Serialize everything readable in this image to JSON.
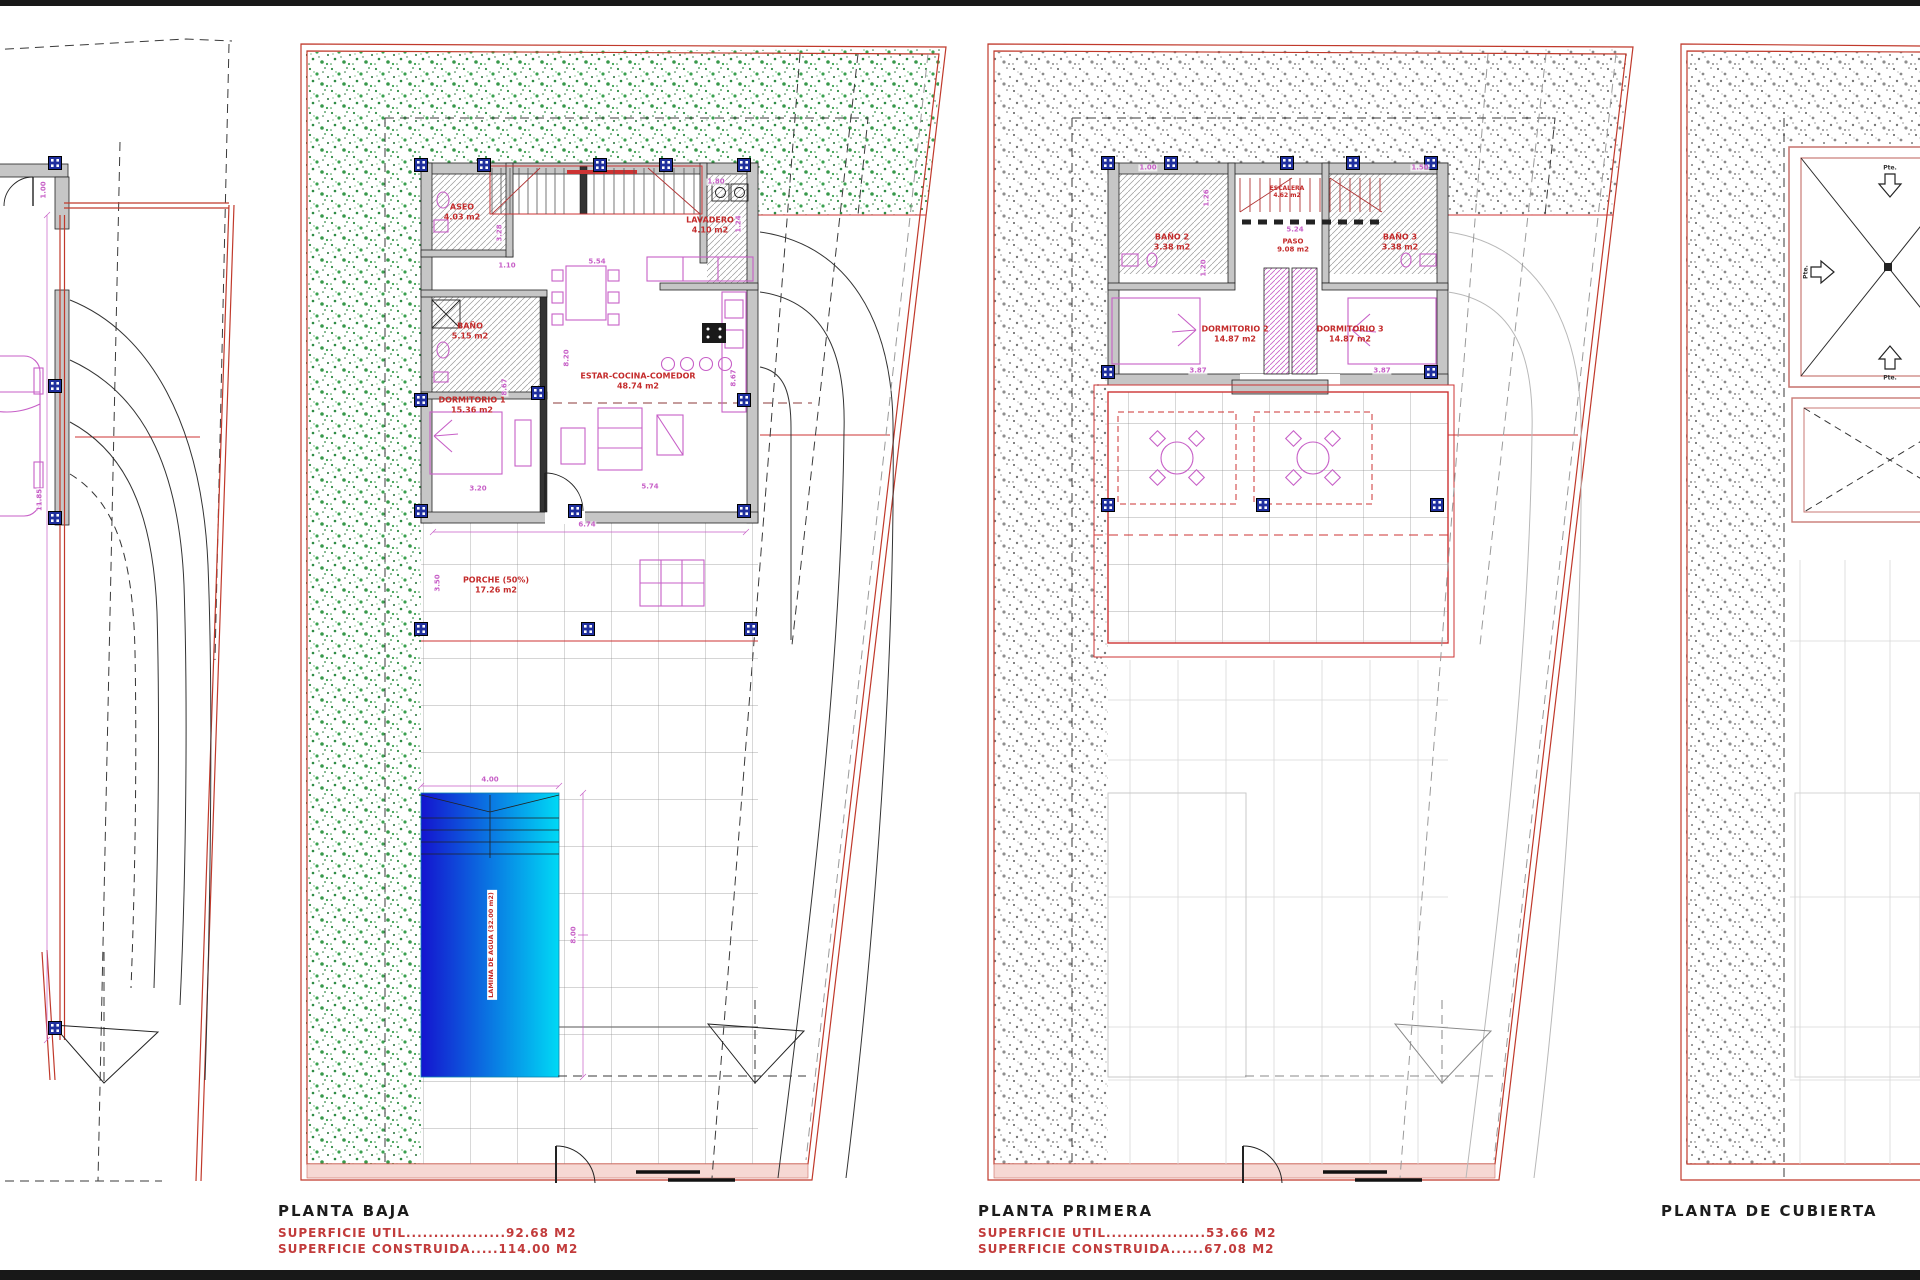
{
  "colors": {
    "boundary_red": "#c0392b",
    "label_red": "#c42b2b",
    "dim_magenta": "#c75fc7",
    "column_blue": "#1f2f9e",
    "garden_green": "#2e8b44",
    "pool_gradient_start": "#1414cf",
    "pool_gradient_end": "#00d9f5"
  },
  "site_plan": {
    "dims": [
      "11.85",
      "1.00"
    ]
  },
  "planta_baja": {
    "title": "PLANTA BAJA",
    "superficie_util": "SUPERFICIE UTIL..................92.68 M2",
    "superficie_construida": "SUPERFICIE CONSTRUIDA.....114.00 M2",
    "rooms": [
      {
        "name": "ASEO",
        "area": "4.03 m2"
      },
      {
        "name": "LAVADERO",
        "area": "4.10 m2"
      },
      {
        "name": "BAÑO",
        "area": "5.15 m2"
      },
      {
        "name": "DORMITORIO 1",
        "area": "15.36 m2"
      },
      {
        "name": "ESTAR-COCINA-COMEDOR",
        "area": "48.74 m2"
      },
      {
        "name": "PORCHE (50%)",
        "area": "17.26 m2"
      }
    ],
    "pool_label": "LAMINA DE AGUA (32.00 m2)",
    "dims": [
      "3.28",
      "1.10",
      "5.54",
      "1.80",
      "1.24",
      "8.20",
      "8.67",
      "8.67",
      "3.20",
      "5.74",
      "6.74",
      "3.50",
      "4.00",
      "8.00"
    ]
  },
  "planta_primera": {
    "title": "PLANTA PRIMERA",
    "superficie_util": "SUPERFICIE UTIL..................53.66 M2",
    "superficie_construida": "SUPERFICIE CONSTRUIDA......67.08 M2",
    "rooms": [
      {
        "name": "BAÑO 2",
        "area": "3.38 m2"
      },
      {
        "name": "BAÑO 3",
        "area": "3.38 m2"
      },
      {
        "name": "DORMITORIO 2",
        "area": "14.87 m2"
      },
      {
        "name": "DORMITORIO 3",
        "area": "14.87 m2"
      },
      {
        "name": "PASO",
        "area": "9.08 m2"
      },
      {
        "name": "ESCALERA",
        "area": "4.62 m2"
      }
    ],
    "dims": [
      "1.00",
      "1.50",
      "5.24",
      "1.26",
      "1.20",
      "3.87",
      "3.87"
    ]
  },
  "planta_cubierta": {
    "title": "PLANTA DE CUBIERTA",
    "slope_label": "Pte."
  }
}
